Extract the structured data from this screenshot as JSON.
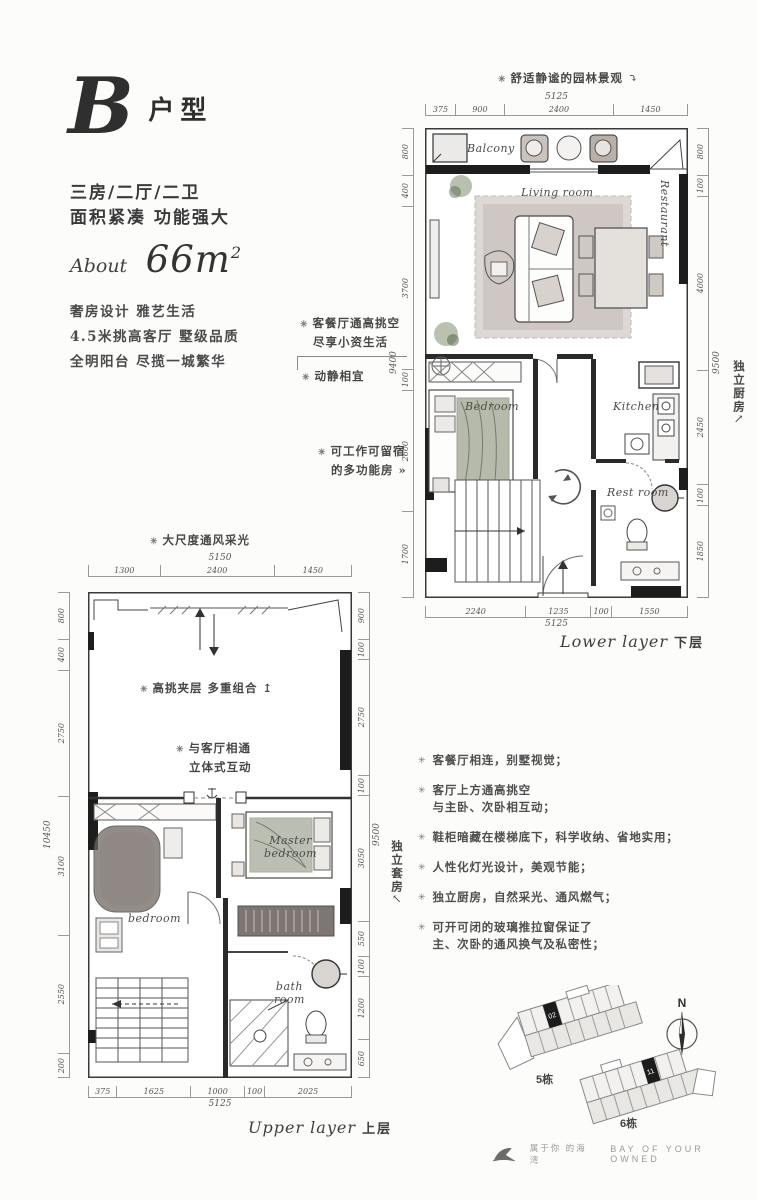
{
  "header": {
    "unit_letter": "B",
    "unit_suffix": "户型",
    "line1": "三房/二厅/二卫",
    "line2": "面积紧凑 功能强大",
    "about_label": "About",
    "area_value": "66m",
    "area_sup": "2",
    "desc1": "奢房设计 雅艺生活",
    "desc2": "4.5米挑高客厅 墅级品质",
    "desc3": "全明阳台 尽揽一城繁华"
  },
  "lower": {
    "note_top": "舒适静谧的园林景观",
    "note_left1a": "客餐厅通高挑空",
    "note_left1b": "尽享小资生活",
    "note_left2": "动静相宜",
    "note_left3a": "可工作可留宿",
    "note_left3b": "的多功能房 »",
    "note_right": "独立厨房",
    "rooms": {
      "balcony": "Balcony",
      "living": "Living room",
      "restaurant": "Restaurant",
      "bedroom": "Bedroom",
      "kitchen": "Kitchen",
      "restroom": "Rest room"
    },
    "dim_top_total": "5125",
    "dim_top": [
      "375",
      "900",
      "2400",
      "1450"
    ],
    "dim_bottom": [
      "2240",
      "1235",
      "100",
      "1550"
    ],
    "dim_bottom_total": "5125",
    "dim_left": [
      "800",
      "400",
      "3700",
      "100",
      "2600",
      "1700"
    ],
    "dim_left_total": "9400",
    "dim_right": [
      "800",
      "100",
      "4000",
      "2450",
      "100",
      "1850"
    ],
    "dim_right_total": "9500",
    "caption_en": "Lower layer",
    "caption_cn": "下层"
  },
  "upper": {
    "note_top": "大尺度通风采光",
    "note_in1": "高挑夹层  多重组合  ↥",
    "note_in2a": "与客厅相通",
    "note_in2b": "立体式互动",
    "note_right": "独立套房",
    "rooms": {
      "master": "Master",
      "master2": "bedroom",
      "bedroom": "bedroom",
      "bath1": "bath",
      "bath2": "room"
    },
    "dim_top_total": "5150",
    "dim_top": [
      "1300",
      "2400",
      "1450"
    ],
    "dim_bottom": [
      "375",
      "1625",
      "1000",
      "100",
      "2025"
    ],
    "dim_bottom_total": "5125",
    "dim_left": [
      "800",
      "400",
      "2750",
      "3100",
      "2550",
      "200"
    ],
    "dim_left_total": "10450",
    "dim_right": [
      "900",
      "100",
      "2750",
      "100",
      "3050",
      "550",
      "100",
      "1200",
      "650"
    ],
    "dim_right_total": "9500",
    "caption_en": "Upper layer",
    "caption_cn": "上层"
  },
  "features": {
    "bullet": "✳",
    "items": [
      [
        "客餐厅相连，别墅视觉；"
      ],
      [
        "客厅上方通高挑空",
        "与主卧、次卧相互动；"
      ],
      [
        "鞋柜暗藏在楼梯底下，科学收纳、省地实用；"
      ],
      [
        "人性化灯光设计，美观节能；"
      ],
      [
        "独立厨房，自然采光、通风燃气；"
      ],
      [
        "可开可闭的玻璃推拉窗保证了",
        "主、次卧的通风换气及私密性；"
      ]
    ]
  },
  "siteplan": {
    "north": "N",
    "building5": "5栋",
    "building6": "6栋",
    "unit5": "02",
    "unit6": "11"
  },
  "footer": {
    "cn": "属于你 的海湾",
    "en": "BAY OF YOUR OWNED"
  }
}
